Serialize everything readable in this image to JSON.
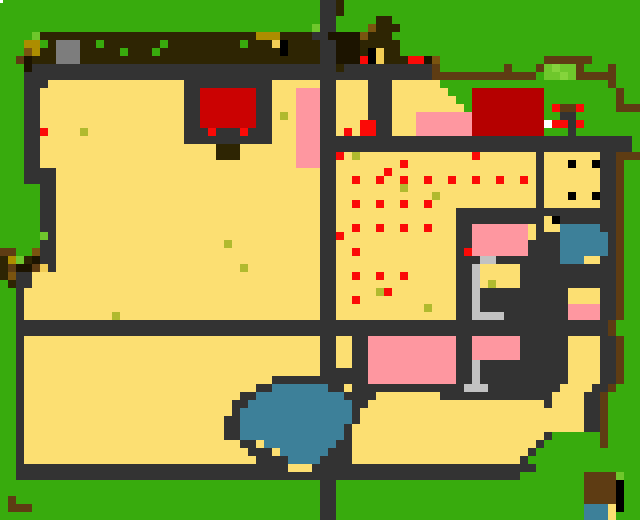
{
  "map": {
    "cols": 80,
    "rows": [
      "GGGGGGGGGGGGGGGGGGGGGGGGGGGGGGGGGGGGGGGGDDNGGGGGGGGGGGGGGGGGGGGGGGGGGGGGGGGGGGG",
      "GGGGGGGGGGGGGGGGGGGGGGGGGGGGGGGGGGGGGGGGDDNGGGGGGGGGGGGGGGGGGGGGGGGGGGGGGGGGGGG",
      "GGGGGGGGGGGGGGGGGGGGGGGGGGGGGGGGGGGGGGGGDDGGGGGNNGGGGGGGGGGGGGGGGGGGGGGGGGGGGGG",
      "GGGGGGGGGGGGGGGGGGGGGGGGGGGGGGGGGGGGGGGgDDGGGGuNNNGGGGGGGGGGGGGGGGGGGGGGGGGGGGG",
      "GGGGgNNNNNNNNNNNNNNNNNNNNNNNNNNNYYYNNNNDDkkkkuNNNGGGGGGGGGGGGGGGGGGGGGGGGGGGGGG",
      "GGGYYoNAAANNoNNNNNNNoNNNNNNNNNoNNNsKNNNNDDkkkNNNNNGGGGGGGGGGGGGGGGGGGGGGGGGGGGG",
      "GGGuYNNAAANNNNNoNNNoNNNNNNNNNNNNNNNKNNNNDDkkkNKsNNGGGGGGGGGGGGGGGGGGGGGGGGGGGGG",
      "GGMkNNNAAANNNNNNNNNNNNNNNNNNNNNNNNNNNNNNDDkkkRKsNNNRRkuGGGGGGGGGGGGGMMMMMMGGGGGG",
      "GGGkDDDDDDDDDDDDDDDDDDDDDDDDDDDDDDDDDDDDDDNDDDDDDDDDDDMGGGGGGGGMGGGMghggMGGGMGG",
      "GGGDDDDDDDDDDDDDDDDDDDDDDDDDDDDDDDDDDDDDDDDDDDDDDDDDDDMMMMMMMMMMMMMGgghgMMMMMGG",
      "GGGDDDSSSSSSSSSSSSSSSSSDDDDDDDDDDDSSSSSSDDSSSSDDDSSSSSSGGGGGGGGGGGGGGGGGGGGGMGG",
      "GGGDDSSSSSSSSSSSSSSSSSSDDCCCCCCCDDSSSPPPDDSSSSDDDSSSSSSSGGGcccccccccGGGGGGGGGMGG",
      "GGGDDSSSSSSSSSSSSSSSSSSDDCCCCCCCDDSSSPPPDDSSSSDDDSSSSSSSSGGcccccccccGGGGGGGGGMGG",
      "GGGDDSSSSSSSSSSSSSSSSSSDDCCCCCCCDDSSSPPPDDSSSSDDDSSSSSSSSSGcccccccccGRMMRGGGGMMM",
      "GGGDDSSSSSSSSSSSSSSSSSSDDCCCCCCCDDSOSPPPDDSSSSDDDSSSPPPPPPPcccccccccGGDDGGGGGGGG",
      "GGGDDSSSSSSSSSSSSSSSSSSDDCCCCCCCDDSSSPPPDDSSSRRDDSSSPPPPPPPcccccccccWRRDRGGGGGGG",
      "GGGDDRSSSSOSSSSSSSSSSSSDDDRDDDRDDDSSSPPPDDSRSRRDDSSSPPPPPPPcccccccccGGGDGGGGGGGG",
      "GGGDDSSSSSSSSSSSSSSSSSSDDDDDDDDDDDSSSPPPDDDDDDDDDDDDDDDDDDDDDDDDDDDDDDDDDDDDDDD",
      "GGGDDSSSSSSSSSSSSSSSSSSSSSSNNNSSSSSSSPPPDDDDDDDDDDDDDDDDDDDDDDDDDDDDDDDDDDDDDDD",
      "GGGDDSSSSSSSSSSSSSSSSSSSSSSNNNSSSSSSSPPPDDRSOSSSSSSSSSSSSSSRSSSSSSSDSSSSSSSDDMMM",
      "GGGDDSSSSSSSSSSSSSSSSSSSSSSSSSSSSSSSSPPPDDSSSSSSSSRSSSSSSSSSSSSSSSSDSSSKSSKDDMGG",
      "GGGDDDDSSSSSSSSSSSSSSSSSSSSSSSSSSSSSSSSSDDSSSSSSRSSSSSSSSSSSSSSSSSSDSSSSSSSDDMGG",
      "GGGDDDDSSSSSSSSSSSSSSSSSSSSSSSSSSSSSSSSSDDSSRSSRSSRSSRSSRSSRSSRSSRSDSSSSSSSDDMGG",
      "GGGGGDDSSSSSSSSSSSSSSSSSSSSSSSSSSSSSSSSSDDSSSSSSSSOSSSSSSSSSSSSSSSSDSSSSSSSDDMGG",
      "GGGGGDDSSSSSSSSSSSSSSSSSSSSSSSSSSSSSSSSSDDSSSSSSSSSSSSOSSSSSSSSSSSSDSSSKSSKDDMGG",
      "GGGGGDDSSSSSSSSSSSSSSSSSSSSSSSSSSSSSSSSSDDSSRSSRSSRSSRSSSSSSSSSSSSSDSSSSSSSDDMGG",
      "GGGGGDDSSSSSSSSSSSSSSSSSSSSSSSSSSSSSSSSSDDSSSSSSSSSSSSSSSDDDDDDDDDDDDDDDDDDDDMGG",
      "GGGGGDDSSSSSSSSSSSSSSSSSSSSSSSSSSSSSSSSSDDSSSSSSSSSSSSSSSDDDDDDDDDDDSKDDDDDDDMGG",
      "GGGGGDDSSSSSSSSSSSSSSSSSSSSSSSSSSSSSSSSSDDSSRSSRSSRSSRSSSDDPPPPPPPSDSSBBBBBDDMGG",
      "GGGGGgDSSSSSSSSSSSSSSSSSSSSSSSSSSSSSSSSSDDRSSSSSSSSSSSSSSDDPPPPPPPSDDDBBBBBBDMGG",
      "GGGGGDDSSSSSSSSSSSSSSSSSSSSSOSSSSSSSSSSSDDSSSSSSSSSSSSSSSDDPPPPPPPDDDDBBBBBBDMGG",
      "MMGGuDDSSSSSSSSSSSSSSSSSSSSSSSSSSSSSSSSSDDSSRSSSSSSSSSSSSDRPPPPPPPDDDDBBBBBBDMGG",
      "NYgNkDDSSSSSSSSSSSSSSSSSSSSSSSSSSSSSSSSSDDSSSSSSSSSSSSSSSDDDLLDDDDDDDDBBBSSDDMGG",
      "NMkkMsDSSSSSSSSSSSSSSSSSSSSSSSOSSSSSSSSSDDSSSSSSSSSSSSSSSDDLSSSSSDDDDDDDDDDDDMGG",
      "NuDDSSSSSSSSSSSSSSSSSSSSSSSSSSSSSSSSSSSSDDSSRSSRSSRSSSSSSDDLSSSSSDDDDDDDDDDDDMGG",
      "GNDDSSSSSSSSSSSSSSSSSSSSSSSSSSSSSSSSSSSSDDSSSSSSSSSSSSSSSDDLSOSSSDDDDDDDDDDDDMGG",
      "GGDSSSSSSSSSSSSSSSSSSSSSSSSSSSSSSSSSSSSSDDSSSSSORSSSSSSSSDDLDDDDDDDDDDDSSSSDDMGG",
      "GGDSSSSSSSSSSSSSSSSSSSSSSSSSSSSSSSSSSSSSDDSSRSSSSSSSSSSSSDDLDDDDDDDDDDDSSSSDDMGG",
      "GGDSSSSSSSSSSSSSSSSSSSSSSSSSSSSSSSSSSSSSDDSSSSSSSSSSSOSSSDDLDDDDDDDDDDDPPPPDDMGG",
      "GGDSSSSSSSSSSSOSSSSSSSSSSSSSSSSSSSSSSSSSDDSSSSSSSSSSSSSSSDDLLLLDDDDDDDDPPPPDDMGG",
      "GGDDDDDDDDDDDDDDDDDDDDDDDDDDDDDDDDDDDDDDDDDDDDDDDDDDDDDDDDDDDDDDDDDDDDDDDDDDMGG",
      "GGDDDDDDDDDDDDDDDDDDDDDDDDDDDDDDDDDDDDDDDDDDDDDDDDDDDDDDDDDDDDDDDDDDDDDDDDDDMGG",
      "GGDSSSSSSSSSSSSSSSSSSSSSSSSSSSSSSSSSSSSSDDSSDDPPPPPPPPPPPDDPPPPPPDDDDDDSSSSDDMGG",
      "GGDSSSSSSSSSSSSSSSSSSSSSSSSSSSSSSSSSSSSSDDSSDDPPPPPPPPPPPDDPPPPPPDDDDDDSSSSDDMGG",
      "GGDSSSSSSSSSSSSSSSSSSSSSSSSSSSSSSSSSSSSSDDSSDDPPPPPPPPPPPDDPPPPPPDDDDDDSSSSDDMGG",
      "GGDSSSSSSSSSSSSSSSSSSSSSSSSSSSSSSSSSSSSSDDSSDDPPPPPPPPPPPDDLDDDDDDDDDDDSSSSDDMGG",
      "GGDSSSSSSSSSSSSSSSSSSSSSSSSSSSSSSSSSSSSSDDDDDDPPPPPPPPPPPDDLDDDDDDDDDDDSSSSDDMGG",
      "GGDSSSSSSSSSSSSSSSSSSSSSSSSSSSSSSSDDDDDDDDDDDDPPPPPPPPPPPDDLDDDDDDDDDDDSSSSDDMGG",
      "GGDSSSSSSSSSSSSSSSSSSSSSSSSSSSSSDDBBBBBBBDDSDDDDDDDDDDDDDDLLLDDDDDDDDDSSSSDDMGG",
      "GGDSSSSSSSSSSSSSSSSSSSSSSSSSSSDDBBBBBBBBBBBDDDDSSSSSSSSDDDDDDDDDDDDDDSSSSDDMGG",
      "GGDSSSSSSSSSSSSSSSSSSSSSSSSSSDDBBBBBBBBBBBBBDDSSSSSSSSSSSSSSSSSSSSSSDSSSSDDMGG",
      "GGDSSSSSSSSSSSSSSSSSSSSSSSSSSDBBBBBBBBBBBBBBDSSSSSSSSSSSSSSSSSSSSSSSSSSSSDDMGG",
      "GGDSSSSSSSSSSSSSSSSSSSSSSSSSDDBBBBBBBBBBBBBBDSSSSSSSSSSSSSSSSSSSSSSSSSSSSDDMGG",
      "GGDSSSSSSSSSSSSSSSSSSSSSSSSSDDBBBBBBBBBBBBBDSSSSSSSSSSSSSSSSSSSSSSSSSSSSSDDMGG",
      "GGDSSSSSSSSSSSSSSSSSSSSSSSSSDDBBBBBBBBBBBBBDSSSSSSSSSSSSSSSSSSSSSSSSDGGGGGGMGG",
      "GGDSSSSSSSSSSSSSSSSSSSSSSSSSSSDDSBBBBBBBBBDDSSSSSSSSSSSSSSSSSSSSSSSDGGGGGGGMGG",
      "GGDSSSSSSSSSSSSSSSSSSSSSSSSSSSSDDDSBBBBBBDDDSSSSSSSSSSSSSSSSSSSSSSDGGGGGGGGGGG",
      "GGDSSSSSSSSSSSSSSSSSSSSSSSSSSSSSDDDDBBBBDDDDSSSSSSSSSSSSSSSSSSSSSDGGGGGGGGGGGG",
      "GGDDDDDDDDDDDDDDDDDDDDDDDDDDDDDDDDDDSSSDDDDDDDDDDDDDDDDDDDDDDDDDDDDGGGGGGGGGGGG",
      "GGDDDDDDDDDDDDDDDDDDDDDDDDDDDDDDDDDDDDDDDDDDDDDDDDDDDDDDDDDDDDDDDGGGGGGGGMMMMg",
      "GGGGGGGGGGGGGGGGGGGGGGGGGGGGGGGGGGGGGGGGDDGGGGGGGGGGGGGGGGGGGGGGGGGGGGGGGMMMMK",
      "GGGGGGGGGGGGGGGGGGGGGGGGGGGGGGGGGGGGGGGGDDGGGGGGGGGGGGGGGGGGGGGGGGGGGGGGGMMMMK",
      "GMGGGGGGGGGGGGGGGGGGGGGGGGGGGGGGGGGGGGGGDDGGGGGGGGGGGGGGGGGGGGGGGGGGGGGGGMMMMK",
      "GMMMGGGGGGGGGGGGGGGGGGGGGGGGGGGGGGGGGGGGDDGGGGGGGGGGGGGGGGGGGGGGGGGGGGGGGBBBSK",
      "GGGGGGGGGGGGGGGGGGGGGGGGGGGGGGGGGGGGGGGGDDGGGGGGGGGGGGGGGGGGGGGGGGGGGGGGGBBBSG"
    ],
    "cell_size": 8,
    "palette": {
      "G": "#38ab0d",
      "g": "#6fc72c",
      "h": "#85d43c",
      "D": "#333333",
      "S": "#fcdf72",
      "s": "#f2cd55",
      "O": "#b0ba2e",
      "R": "#fb0a07",
      "C": "#cb0202",
      "c": "#b50000",
      "P": "#fe97a0",
      "B": "#3d8099",
      "N": "#2e2503",
      "M": "#5e3c13",
      "K": "#000000",
      "k": "#1c1400",
      "A": "#7d7d7d",
      "L": "#c2c2c2",
      "W": "#ffffff",
      "Y": "#ad8d00",
      "u": "#7a5410"
    },
    "legend": {
      "G": "grass",
      "g": "light-grass",
      "h": "bush-highlight",
      "D": "stone-path",
      "S": "sand-field",
      "s": "light-gold",
      "O": "seed-grass-tuft",
      "R": "red-crop",
      "C": "red-roof-west",
      "c": "red-roof-east",
      "P": "pink-flower-bed",
      "B": "water",
      "N": "dark-soil",
      "M": "wood-fence",
      "K": "black-post",
      "k": "charred-soil",
      "A": "stone-block",
      "L": "light-stone-bracket",
      "W": "white-flower",
      "Y": "gold-block",
      "u": "umber-wood"
    },
    "overlays": [
      {
        "name": "white-speck",
        "x": 0,
        "y": 0,
        "w": 3,
        "h": 3,
        "color": "#ffffff"
      }
    ]
  }
}
